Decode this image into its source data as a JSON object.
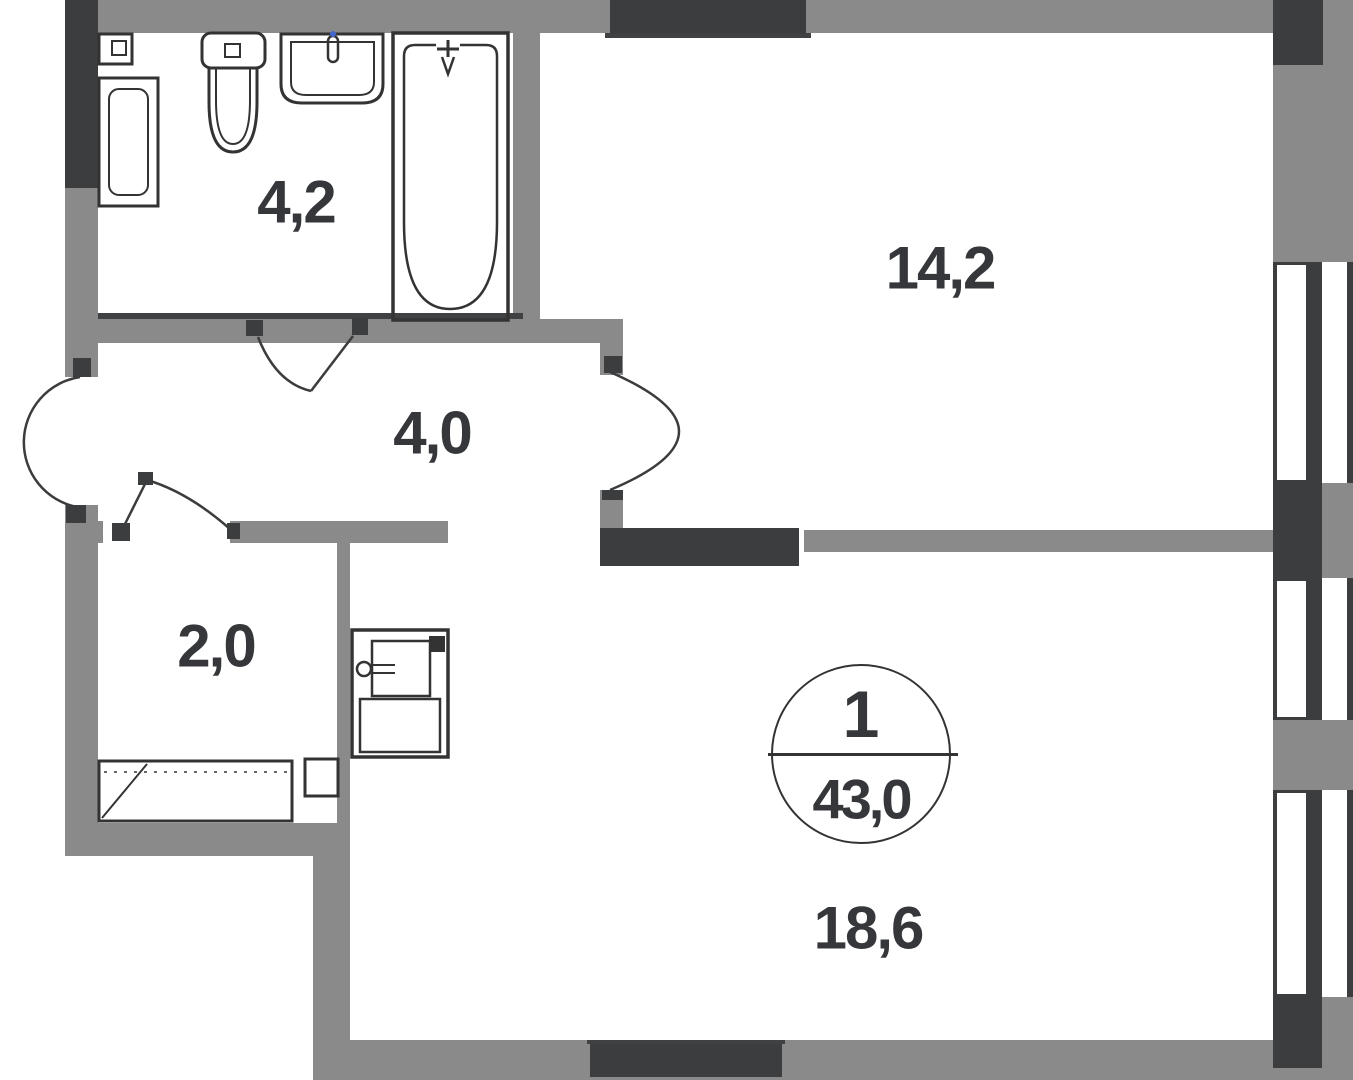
{
  "plan": {
    "rooms": [
      {
        "name": "bathroom",
        "area": "4,2"
      },
      {
        "name": "room",
        "area": "14,2"
      },
      {
        "name": "hallway",
        "area": "4,0"
      },
      {
        "name": "wardrobe",
        "area": "2,0"
      },
      {
        "name": "living-kitchen",
        "area": "18,6"
      }
    ],
    "badge": {
      "room_count": "1",
      "total_area": "43,0"
    },
    "colors": {
      "wall_gray": "#8a8a8a",
      "wall_dark": "#3b3d3e",
      "fixture_line": "#333333",
      "text": "#35373a",
      "faucet_dot": "#4466cc",
      "background": "#ffffff"
    }
  }
}
